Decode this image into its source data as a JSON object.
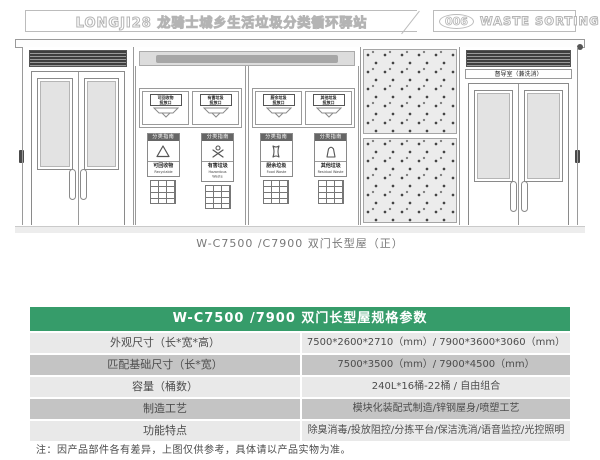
{
  "header": {
    "left_title": "LONGJI28 龙骑士城乡生活垃圾分类循环驿站",
    "badge": "006",
    "right_title": "WASTE SORTING STATION"
  },
  "drawing": {
    "caption": "W-C7500 /C7900 双门长型屋（正）",
    "room_label": "督导室（兼洗消）",
    "ports": [
      {
        "label": "可回收物\n投放口"
      },
      {
        "label": "有害垃圾\n投放口"
      },
      {
        "label": "厨余垃圾\n投放口"
      },
      {
        "label": "其他垃圾\n投放口"
      }
    ],
    "signs": [
      {
        "head": "分类指南",
        "cn": "可回收物",
        "en": "Recyclable"
      },
      {
        "head": "分类指南",
        "cn": "有害垃圾",
        "en": "Hazardous Waste"
      },
      {
        "head": "分类指南",
        "cn": "厨余垃圾",
        "en": "Food Waste"
      },
      {
        "head": "分类指南",
        "cn": "其他垃圾",
        "en": "Residual Waste"
      }
    ]
  },
  "table": {
    "title": "W-C7500 /7900 双门长型屋规格参数",
    "rows": [
      {
        "label": "外观尺寸（长*宽*高）",
        "value": "7500*2600*2710（mm）/ 7900*3600*3060（mm）"
      },
      {
        "label": "匹配基础尺寸（长*宽）",
        "value": "7500*3500（mm）/ 7900*4500（mm）"
      },
      {
        "label": "容量（桶数）",
        "value": "240L*16桶-22桶 / 自由组合"
      },
      {
        "label": "制造工艺",
        "value": "模块化装配式制造/锌钢屋身/喷塑工艺"
      },
      {
        "label": "功能特点",
        "value": "除臭消毒/投放阻控/分拣平台/保洁洗消/语音监控/光控照明"
      }
    ]
  },
  "footnote": "注：因产品部件各有差异，上图仅供参考，具体请以产品实物为准。",
  "colors": {
    "accent_green": "#369c6a",
    "row_light": "#e9e9e9",
    "row_dark": "#c4c4c4",
    "vent_dark": "#3f3f3f"
  }
}
